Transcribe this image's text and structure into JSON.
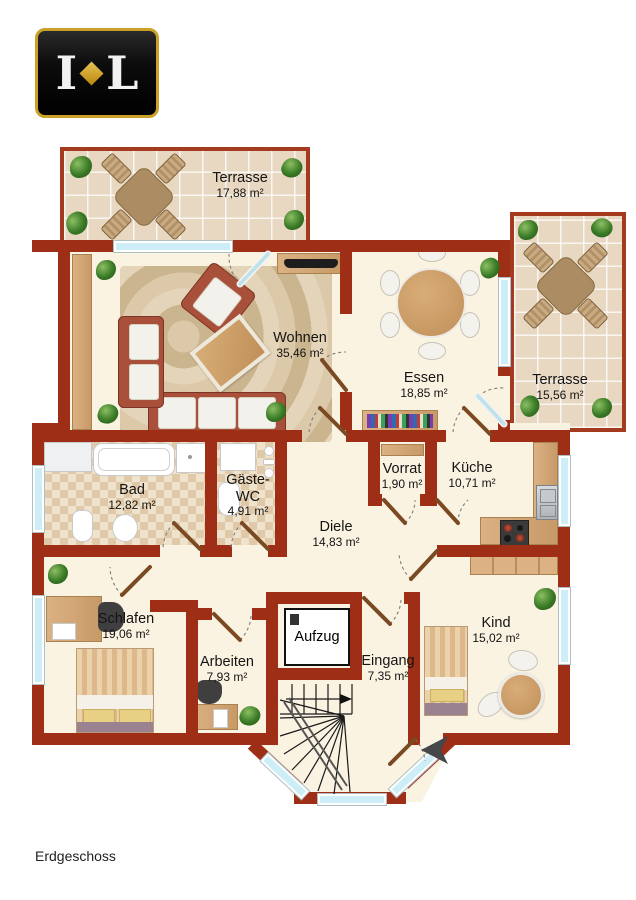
{
  "page": {
    "floor_label": "Erdgeschoss"
  },
  "logo": {
    "letter_left": "I",
    "letter_right": "L",
    "diamond_color": "#d4a72c",
    "background": "#0c0c0c",
    "border": "#c9a227"
  },
  "colors": {
    "wall": "#9e2e16",
    "floor": "#fbf3e2",
    "terrace_tile": "#e8d8c2",
    "window_glass": "#cdeef6",
    "wood": "#cfa06b",
    "door_leaf": "#7a4a22"
  },
  "rooms": [
    {
      "id": "terrasse-top",
      "name": "Terrasse",
      "area": "17,88 m²"
    },
    {
      "id": "wohnen",
      "name": "Wohnen",
      "area": "35,46 m²"
    },
    {
      "id": "essen",
      "name": "Essen",
      "area": "18,85 m²"
    },
    {
      "id": "terrasse-right",
      "name": "Terrasse",
      "area": "15,56 m²"
    },
    {
      "id": "bad",
      "name": "Bad",
      "area": "12,82 m²"
    },
    {
      "id": "gaeste-wc",
      "name": "Gäste-WC",
      "area": "4,91 m²"
    },
    {
      "id": "vorrat",
      "name": "Vorrat",
      "area": "1,90 m²"
    },
    {
      "id": "kueche",
      "name": "Küche",
      "area": "10,71 m²"
    },
    {
      "id": "diele",
      "name": "Diele",
      "area": "14,83 m²"
    },
    {
      "id": "schlafen",
      "name": "Schlafen",
      "area": "19,06 m²"
    },
    {
      "id": "arbeiten",
      "name": "Arbeiten",
      "area": "7,93 m²"
    },
    {
      "id": "aufzug",
      "name": "Aufzug",
      "area": ""
    },
    {
      "id": "eingang",
      "name": "Eingang",
      "area": "7,35 m²"
    },
    {
      "id": "kind",
      "name": "Kind",
      "area": "15,02 m²"
    }
  ],
  "furniture_icons": {
    "wohnen": [
      "sofa",
      "loveseat",
      "armchair",
      "coffee-table",
      "rug",
      "tv-sideboard",
      "plants"
    ],
    "essen": [
      "round-dining-table",
      "six-chairs",
      "bookshelf",
      "plant"
    ],
    "bad": [
      "bathtub",
      "washbasin-counter",
      "shower",
      "toilet",
      "bidet"
    ],
    "gaeste_wc": [
      "washbasin",
      "toilet"
    ],
    "kueche": [
      "counter",
      "sink",
      "stove"
    ],
    "schlafen": [
      "double-bed",
      "desk",
      "office-chair",
      "plant"
    ],
    "arbeiten": [
      "desk",
      "office-chair",
      "plant"
    ],
    "kind": [
      "single-bed",
      "wardrobe",
      "round-table",
      "two-chairs",
      "plant"
    ],
    "terraces": [
      "patio-table",
      "four-chairs",
      "plants"
    ],
    "misc": [
      "winding-staircase",
      "elevator",
      "entrance-arrow",
      "door-swings",
      "windows"
    ]
  }
}
